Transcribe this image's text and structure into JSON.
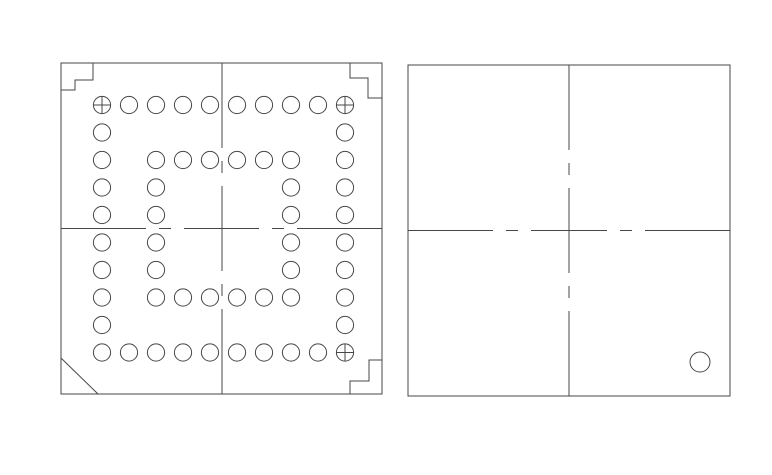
{
  "canvas": {
    "width": 772,
    "height": 475,
    "background_color": "#ffffff",
    "line_color": "#474747",
    "line_width": 1
  },
  "views": {
    "top_view": {
      "outline": {
        "x": 61,
        "y": 63,
        "width": 321,
        "height": 331
      },
      "corner_marks": {
        "top_left_step": [
          [
            93,
            63
          ],
          [
            93,
            80
          ],
          [
            75,
            80
          ],
          [
            75,
            90
          ],
          [
            61,
            90
          ]
        ],
        "top_right_step": [
          [
            350,
            63
          ],
          [
            350,
            78
          ],
          [
            368,
            78
          ],
          [
            368,
            98
          ],
          [
            382,
            98
          ]
        ],
        "bottom_right_step": [
          [
            350,
            394
          ],
          [
            350,
            381
          ],
          [
            369,
            381
          ],
          [
            369,
            360
          ],
          [
            382,
            360
          ]
        ],
        "bottom_left_chamfer": [
          [
            61,
            358
          ],
          [
            98,
            394
          ]
        ]
      },
      "centerlines": {
        "vertical": {
          "x": 222,
          "segments": [
            [
              63,
              148
            ],
            [
              161,
              173
            ],
            [
              186,
              271
            ],
            [
              284,
              296
            ],
            [
              309,
              394
            ]
          ]
        },
        "horizontal": {
          "y": 228.5,
          "segments": [
            [
              61,
              146
            ],
            [
              159,
              171
            ],
            [
              184,
              259
            ],
            [
              272,
              284
            ],
            [
              297,
              382
            ]
          ]
        }
      },
      "ball_grid": {
        "cols_x": [
          102,
          129,
          156,
          183,
          210,
          237,
          264,
          291,
          318,
          345
        ],
        "rows_y": [
          105,
          132.5,
          160,
          187.5,
          215,
          242.5,
          270,
          297.5,
          325,
          352.5
        ],
        "ball_radius": 8.6,
        "pattern": [
          "XOOOOOOOOX",
          "O--------O",
          "O-OOOOOO-O",
          "O-O----O-O",
          "O-O----O-O",
          "O-O----O-O",
          "O-O----O-O",
          "O-OOOOOO-O",
          "O--------O",
          "OOOOOOOOOX"
        ],
        "pattern_legend": {
          "X": "circle-with-cross",
          "O": "circle",
          "-": "empty"
        }
      }
    },
    "bottom_view": {
      "outline": {
        "x": 408,
        "y": 65,
        "width": 322,
        "height": 331
      },
      "centerlines": {
        "vertical": {
          "x": 569,
          "segments": [
            [
              65,
              150
            ],
            [
              163,
              175
            ],
            [
              188,
              273
            ],
            [
              286,
              298
            ],
            [
              311,
              396
            ]
          ]
        },
        "horizontal": {
          "y": 230.5,
          "segments": [
            [
              408,
              493
            ],
            [
              506,
              518
            ],
            [
              531,
              607
            ],
            [
              620,
              632
            ],
            [
              645,
              730
            ]
          ]
        }
      },
      "corner_circle": {
        "cx": 700,
        "cy": 362,
        "r": 10
      }
    }
  }
}
